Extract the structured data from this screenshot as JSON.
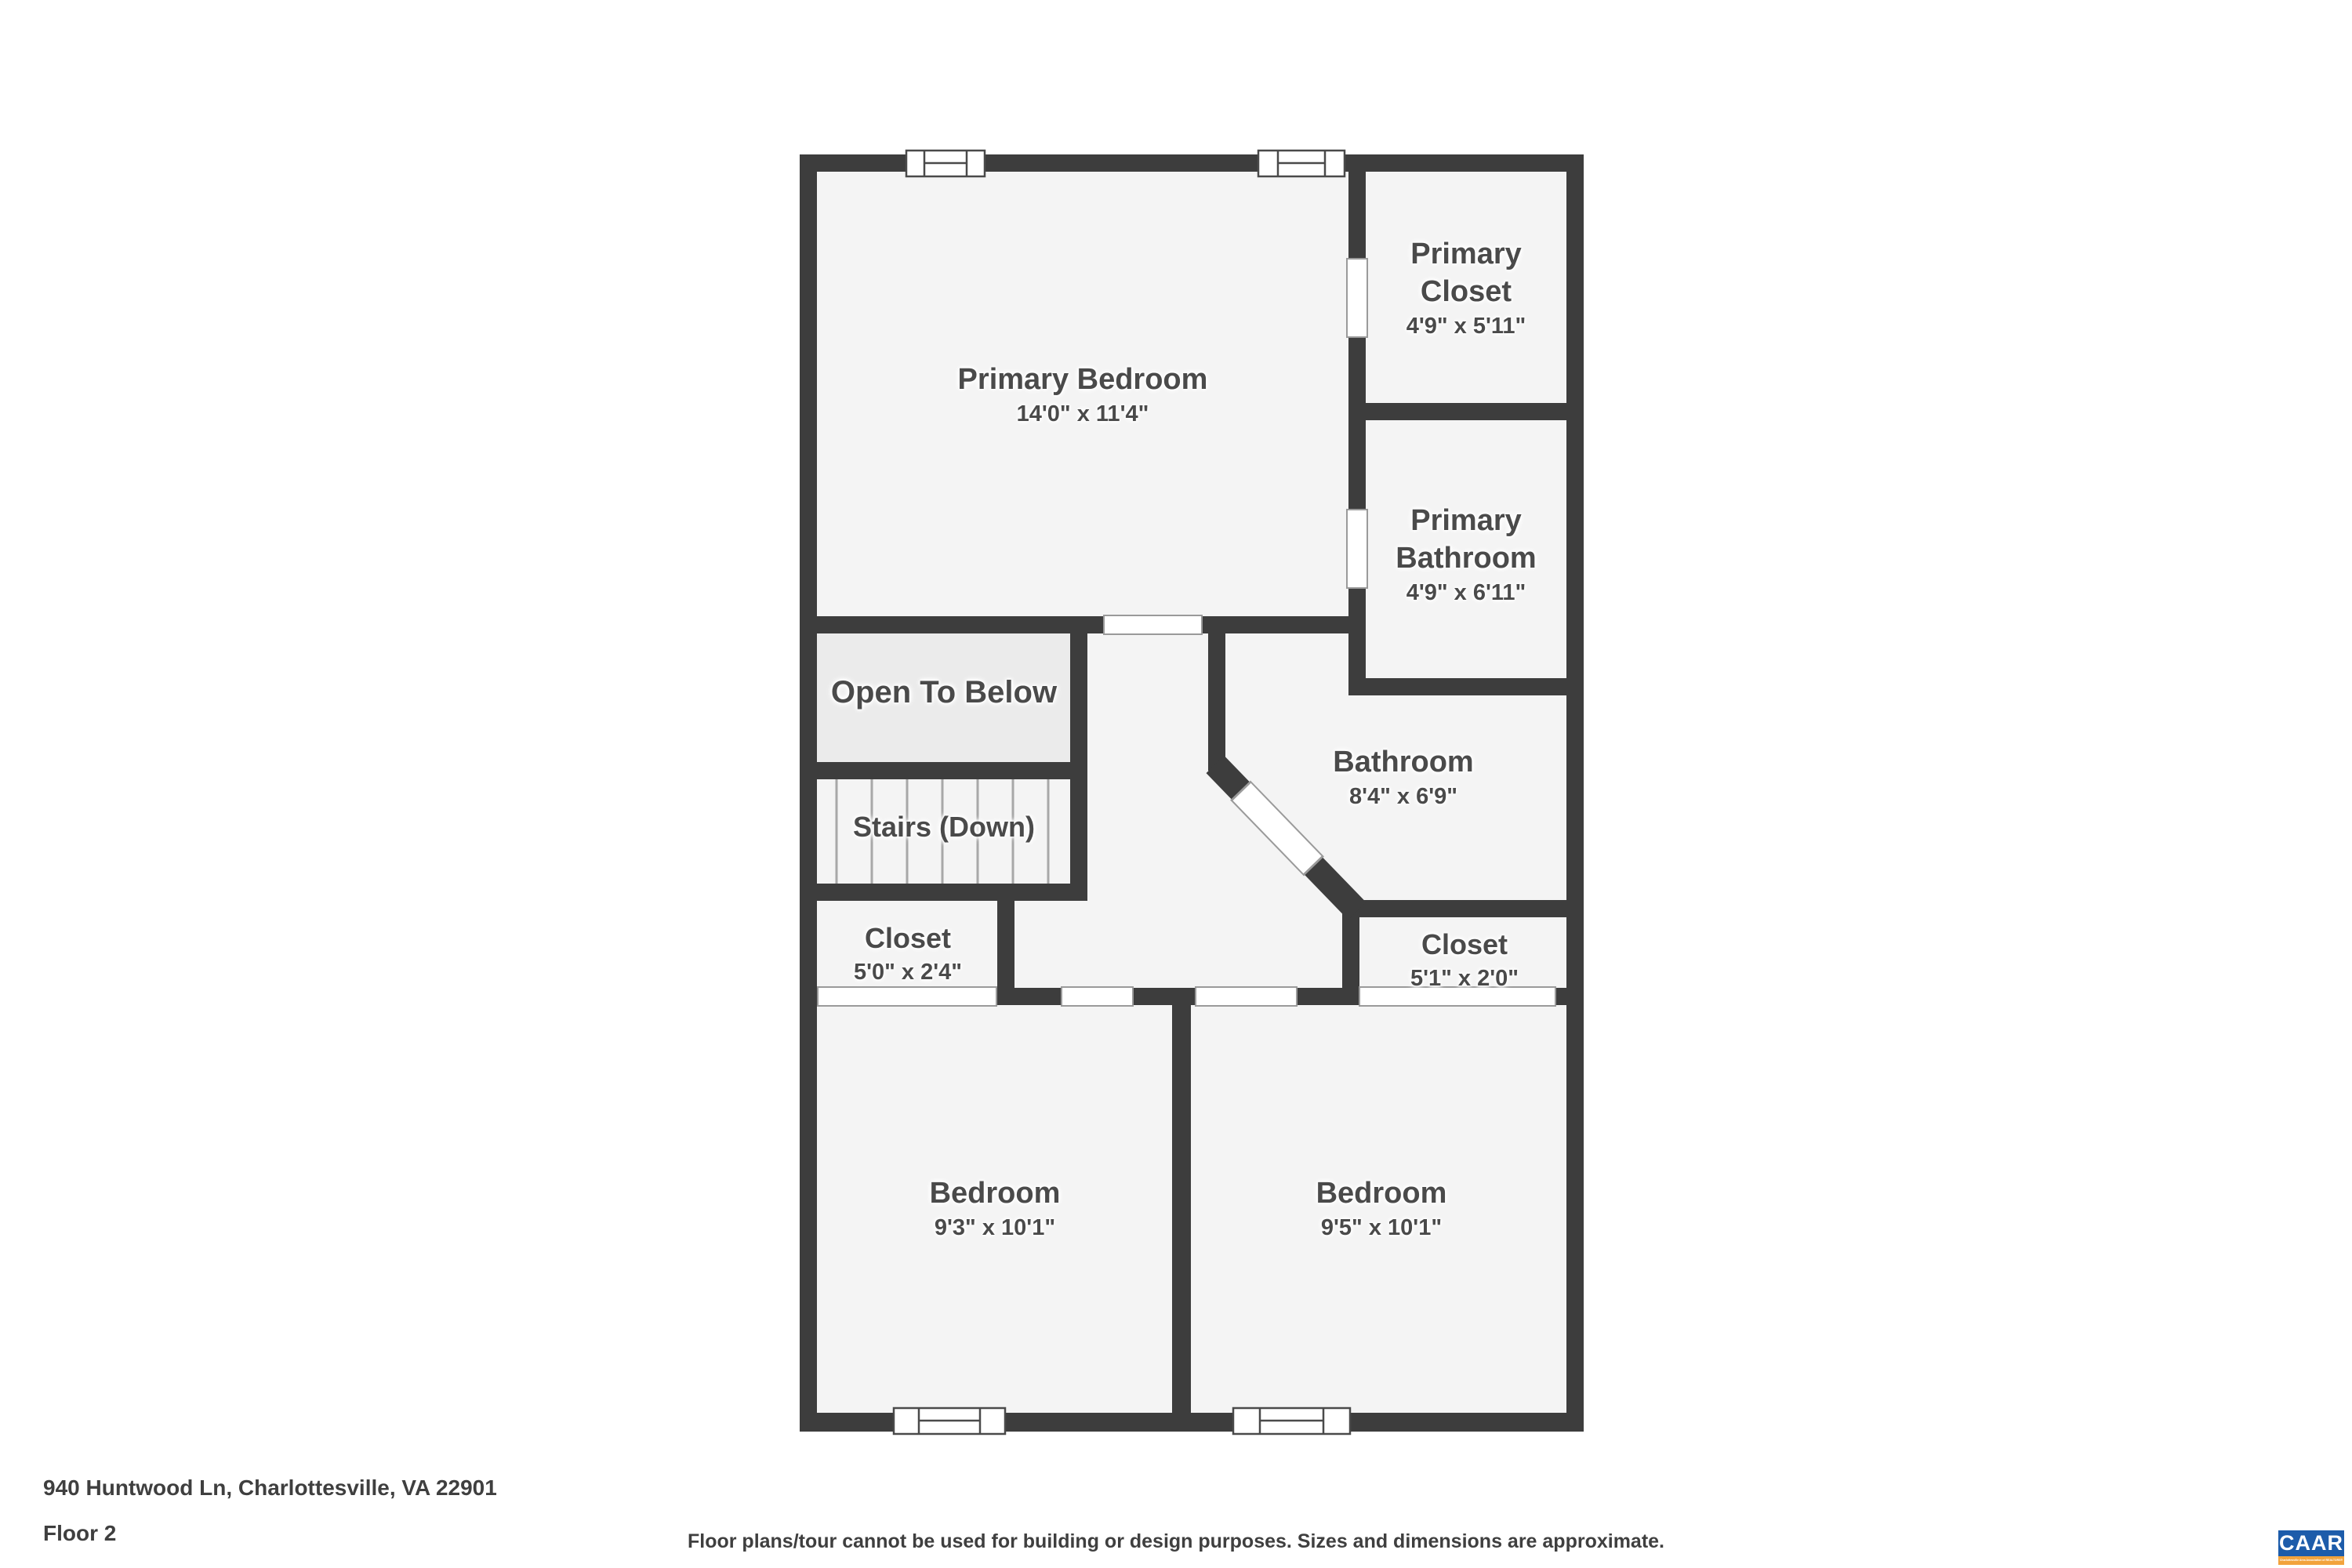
{
  "rooms": {
    "primary_bedroom": {
      "name": "Primary Bedroom",
      "dims": "14'0\" x 11'4\""
    },
    "primary_closet": {
      "line1": "Primary",
      "line2": "Closet",
      "dims": "4'9\" x 5'11\""
    },
    "primary_bathroom": {
      "line1": "Primary",
      "line2": "Bathroom",
      "dims": "4'9\" x 6'11\""
    },
    "bathroom": {
      "name": "Bathroom",
      "dims": "8'4\" x 6'9\""
    },
    "open_to_below": {
      "name": "Open To Below"
    },
    "stairs": {
      "name": "Stairs (Down)"
    },
    "closet_left": {
      "name": "Closet",
      "dims": "5'0\" x 2'4\""
    },
    "closet_right": {
      "name": "Closet",
      "dims": "5'1\" x 2'0\""
    },
    "bedroom_left": {
      "name": "Bedroom",
      "dims": "9'3\" x 10'1\""
    },
    "bedroom_right": {
      "name": "Bedroom",
      "dims": "9'5\" x 10'1\""
    }
  },
  "footer": {
    "address": "940 Huntwood Ln, Charlottesville, VA 22901",
    "floor_label": "Floor 2",
    "disclaimer": "Floor plans/tour cannot be used for building or design purposes. Sizes and dimensions are approximate.",
    "logo": {
      "text": "CAAR",
      "tagline": "Charlottesville Area Association of REALTORS®"
    }
  },
  "colors": {
    "wall": "#3d3d3d",
    "room_fill": "#f4f4f4",
    "open_to_below_fill": "#ebebeb",
    "label_text": "#4a4a4a",
    "logo_blue": "#1d5caa",
    "logo_orange": "#f2a33c"
  }
}
